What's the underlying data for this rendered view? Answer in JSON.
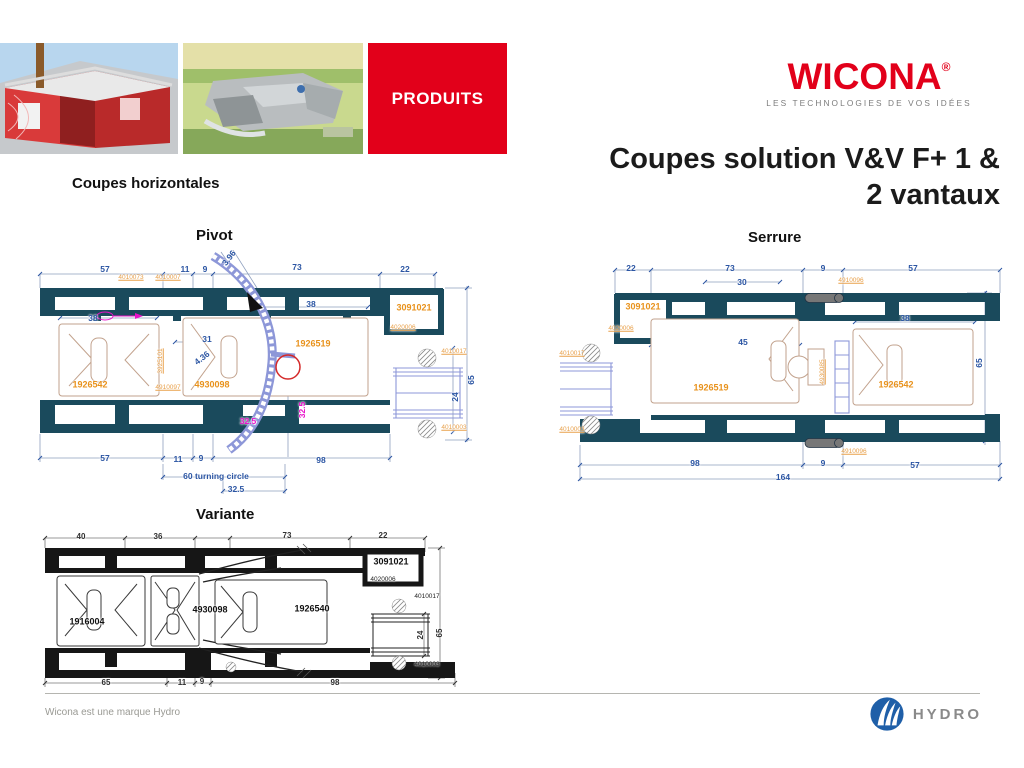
{
  "header": {
    "produits_label": "PRODUITS",
    "logo_text": "WICONA",
    "logo_reg": "®",
    "tagline": "LES TECHNOLOGIES DE VOS IDÉES",
    "title_line1": "Coupes solution V&V F+ 1 &",
    "title_line2": "2 vantaux",
    "section_label": "Coupes horizontales"
  },
  "footer": {
    "note": "Wicona est une marque Hydro",
    "hydro_label": "HYDRO"
  },
  "colors": {
    "wicona_red": "#e2001a",
    "profile_teal": "#1a4a5c",
    "dim_blue": "#2b55a3",
    "part_orange": "#e8921c",
    "magenta": "#e811c9",
    "glazing_periwinkle": "#8d97d8",
    "hydro_blue": "#1f5fa8"
  },
  "drawings": {
    "pivot": {
      "title": "Pivot",
      "labels": [
        {
          "t": "57",
          "x": 70,
          "y": 19,
          "c": "dim"
        },
        {
          "t": "11",
          "x": 150,
          "y": 19,
          "c": "dim"
        },
        {
          "t": "9",
          "x": 170,
          "y": 19,
          "c": "dim"
        },
        {
          "t": "3.96",
          "x": 194,
          "y": 8,
          "c": "dim",
          "r": -52
        },
        {
          "t": "73",
          "x": 262,
          "y": 17,
          "c": "dim"
        },
        {
          "t": "22",
          "x": 370,
          "y": 19,
          "c": "dim"
        },
        {
          "t": "4010073",
          "x": 96,
          "y": 28,
          "c": "partsm"
        },
        {
          "t": "4010007",
          "x": 133,
          "y": 28,
          "c": "partsm"
        },
        {
          "t": "38",
          "x": 58,
          "y": 68,
          "c": "dim"
        },
        {
          "t": "38",
          "x": 276,
          "y": 54,
          "c": "dim"
        },
        {
          "t": "3091021",
          "x": 379,
          "y": 58,
          "c": "part"
        },
        {
          "t": "4020006",
          "x": 368,
          "y": 78,
          "c": "partsm"
        },
        {
          "t": "31",
          "x": 172,
          "y": 89,
          "c": "dim"
        },
        {
          "t": "4.36",
          "x": 167,
          "y": 108,
          "c": "dim",
          "r": -38
        },
        {
          "t": "1926519",
          "x": 278,
          "y": 94,
          "c": "part"
        },
        {
          "t": "4010017",
          "x": 419,
          "y": 102,
          "c": "partsm"
        },
        {
          "t": "3925101",
          "x": 126,
          "y": 111,
          "c": "partsm",
          "r": -90
        },
        {
          "t": "1926542",
          "x": 55,
          "y": 135,
          "c": "part"
        },
        {
          "t": "4930098",
          "x": 177,
          "y": 135,
          "c": "part"
        },
        {
          "t": "4910097",
          "x": 133,
          "y": 138,
          "c": "partsm"
        },
        {
          "t": "65",
          "x": 436,
          "y": 130,
          "c": "dim",
          "r": -90
        },
        {
          "t": "24",
          "x": 420,
          "y": 147,
          "c": "dim",
          "r": -90
        },
        {
          "t": "32.5",
          "x": 213,
          "y": 171,
          "c": "mag"
        },
        {
          "t": "32.5",
          "x": 267,
          "y": 160,
          "c": "mag",
          "r": -90
        },
        {
          "t": "4010003",
          "x": 419,
          "y": 178,
          "c": "partsm"
        },
        {
          "t": "57",
          "x": 70,
          "y": 208,
          "c": "dim"
        },
        {
          "t": "11",
          "x": 143,
          "y": 209,
          "c": "dim"
        },
        {
          "t": "9",
          "x": 166,
          "y": 208,
          "c": "dim"
        },
        {
          "t": "98",
          "x": 286,
          "y": 210,
          "c": "dim"
        },
        {
          "t": "60 turning circle",
          "x": 181,
          "y": 226,
          "c": "dim"
        },
        {
          "t": "32.5",
          "x": 201,
          "y": 239,
          "c": "dim"
        }
      ]
    },
    "serrure": {
      "title": "Serrure",
      "labels": [
        {
          "t": "22",
          "x": 76,
          "y": 13,
          "c": "dim"
        },
        {
          "t": "73",
          "x": 175,
          "y": 13,
          "c": "dim"
        },
        {
          "t": "9",
          "x": 268,
          "y": 13,
          "c": "dim"
        },
        {
          "t": "57",
          "x": 358,
          "y": 13,
          "c": "dim"
        },
        {
          "t": "30",
          "x": 187,
          "y": 27,
          "c": "dim"
        },
        {
          "t": "4910096",
          "x": 296,
          "y": 26,
          "c": "partsm"
        },
        {
          "t": "3091021",
          "x": 88,
          "y": 52,
          "c": "part"
        },
        {
          "t": "4020006",
          "x": 66,
          "y": 74,
          "c": "partsm"
        },
        {
          "t": "38",
          "x": 350,
          "y": 63,
          "c": "dim"
        },
        {
          "t": "45",
          "x": 188,
          "y": 87,
          "c": "dim"
        },
        {
          "t": "4010017",
          "x": 17,
          "y": 99,
          "c": "partsm"
        },
        {
          "t": "4930085",
          "x": 268,
          "y": 117,
          "c": "partsm",
          "r": -90
        },
        {
          "t": "1926519",
          "x": 156,
          "y": 133,
          "c": "part"
        },
        {
          "t": "1926542",
          "x": 341,
          "y": 130,
          "c": "part"
        },
        {
          "t": "65",
          "x": 424,
          "y": 108,
          "c": "dim",
          "r": -90
        },
        {
          "t": "4010003",
          "x": 17,
          "y": 175,
          "c": "partsm"
        },
        {
          "t": "4910096",
          "x": 299,
          "y": 197,
          "c": "partsm"
        },
        {
          "t": "98",
          "x": 140,
          "y": 208,
          "c": "dim"
        },
        {
          "t": "9",
          "x": 268,
          "y": 208,
          "c": "dim"
        },
        {
          "t": "57",
          "x": 360,
          "y": 210,
          "c": "dim"
        },
        {
          "t": "164",
          "x": 228,
          "y": 222,
          "c": "dim"
        }
      ]
    },
    "variante": {
      "title": "Variante",
      "labels": [
        {
          "t": "40",
          "x": 46,
          "y": 7,
          "c": "dimk"
        },
        {
          "t": "36",
          "x": 123,
          "y": 7,
          "c": "dimk"
        },
        {
          "t": "73",
          "x": 252,
          "y": 6,
          "c": "dimk"
        },
        {
          "t": "22",
          "x": 348,
          "y": 6,
          "c": "dimk"
        },
        {
          "t": "3091021",
          "x": 356,
          "y": 32,
          "c": "blk"
        },
        {
          "t": "4020006",
          "x": 348,
          "y": 50,
          "c": "blksm"
        },
        {
          "t": "4010017",
          "x": 392,
          "y": 67,
          "c": "blksm"
        },
        {
          "t": "4930098",
          "x": 175,
          "y": 80,
          "c": "blk"
        },
        {
          "t": "1926540",
          "x": 277,
          "y": 79,
          "c": "blk"
        },
        {
          "t": "1916004",
          "x": 52,
          "y": 92,
          "c": "blk"
        },
        {
          "t": "24",
          "x": 386,
          "y": 105,
          "c": "dimk",
          "r": -90
        },
        {
          "t": "65",
          "x": 405,
          "y": 103,
          "c": "dimk",
          "r": -90
        },
        {
          "t": "4010003",
          "x": 392,
          "y": 135,
          "c": "blksm"
        },
        {
          "t": "65",
          "x": 71,
          "y": 153,
          "c": "dimk"
        },
        {
          "t": "11",
          "x": 147,
          "y": 153,
          "c": "dimk"
        },
        {
          "t": "9",
          "x": 167,
          "y": 152,
          "c": "dimk"
        },
        {
          "t": "98",
          "x": 300,
          "y": 153,
          "c": "dimk"
        }
      ]
    }
  }
}
